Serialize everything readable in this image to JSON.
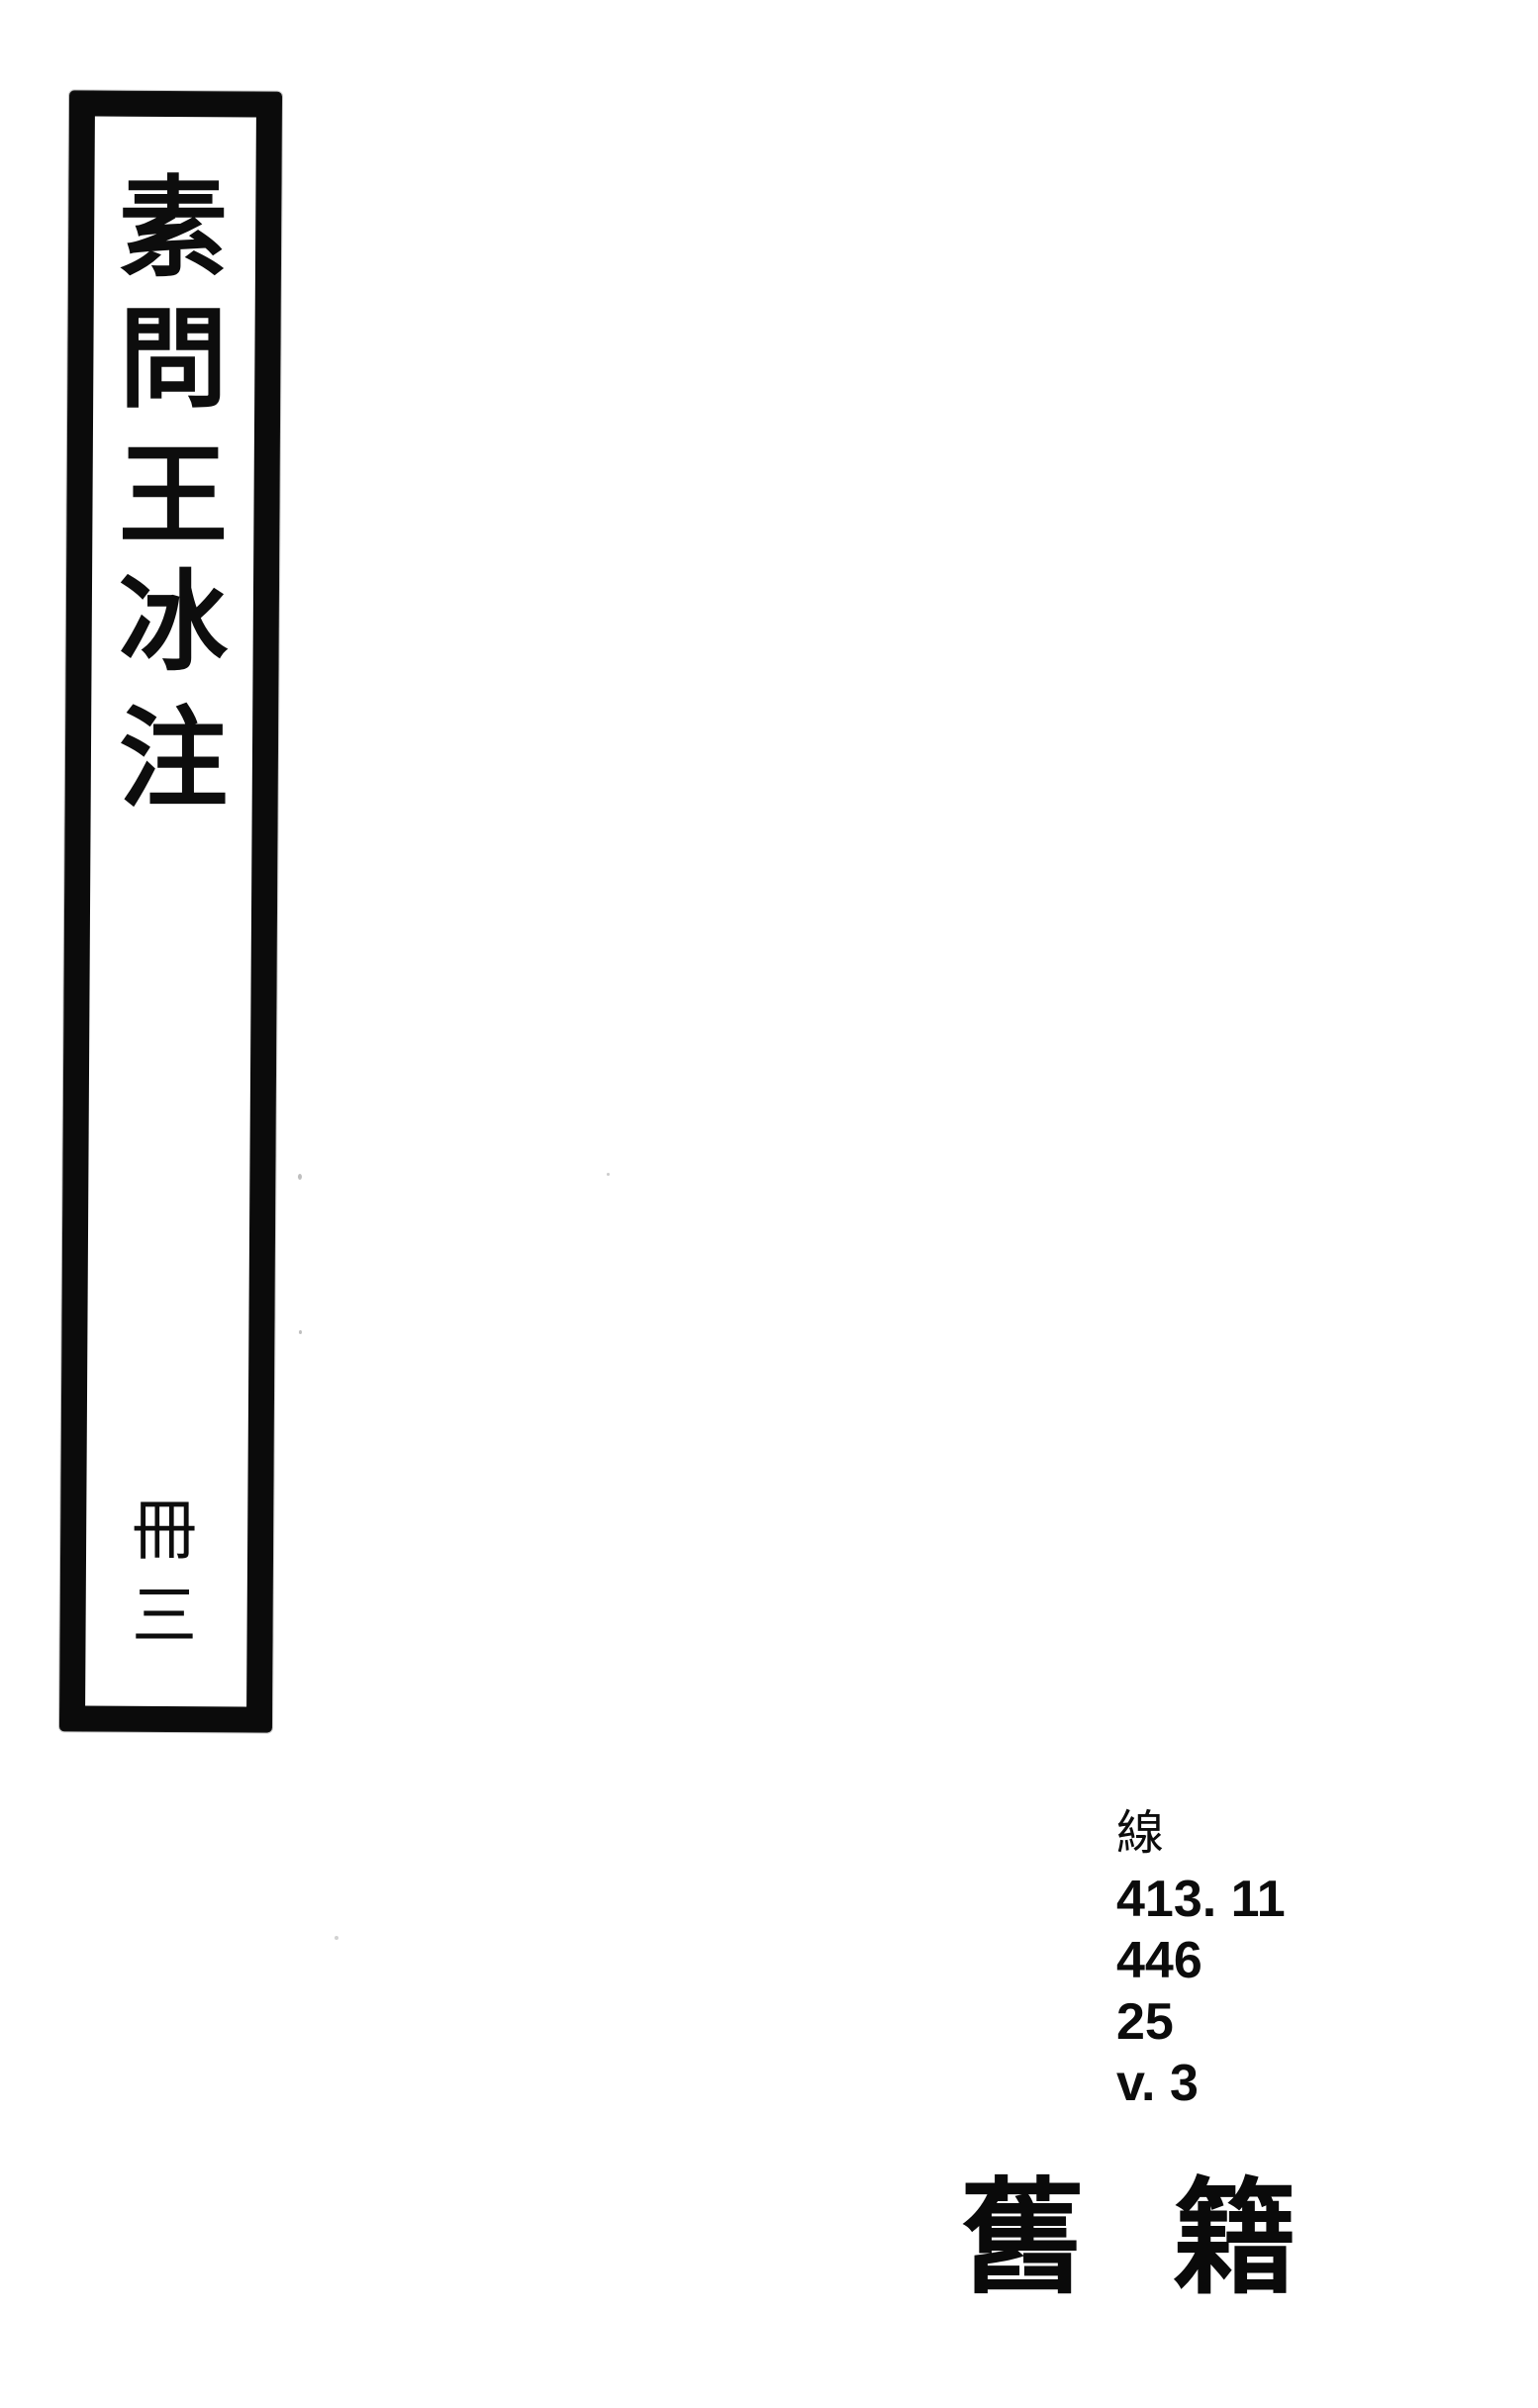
{
  "page": {
    "kind": "scanned-library-book-cover",
    "colors": {
      "paper": "#ffffff",
      "ink": "#0b0b0b"
    }
  },
  "spine_label": {
    "title": "素問王冰注",
    "title_chars": [
      "素",
      "問",
      "王",
      "冰",
      "注"
    ],
    "volume": "冊三",
    "volume_chars": [
      "冊",
      "三"
    ]
  },
  "call_number": {
    "material_class": "線",
    "lines": [
      "413. 11",
      "446",
      "25",
      "v. 3"
    ]
  },
  "stamp": {
    "label": "舊籍",
    "chars": [
      "舊",
      "籍"
    ]
  }
}
